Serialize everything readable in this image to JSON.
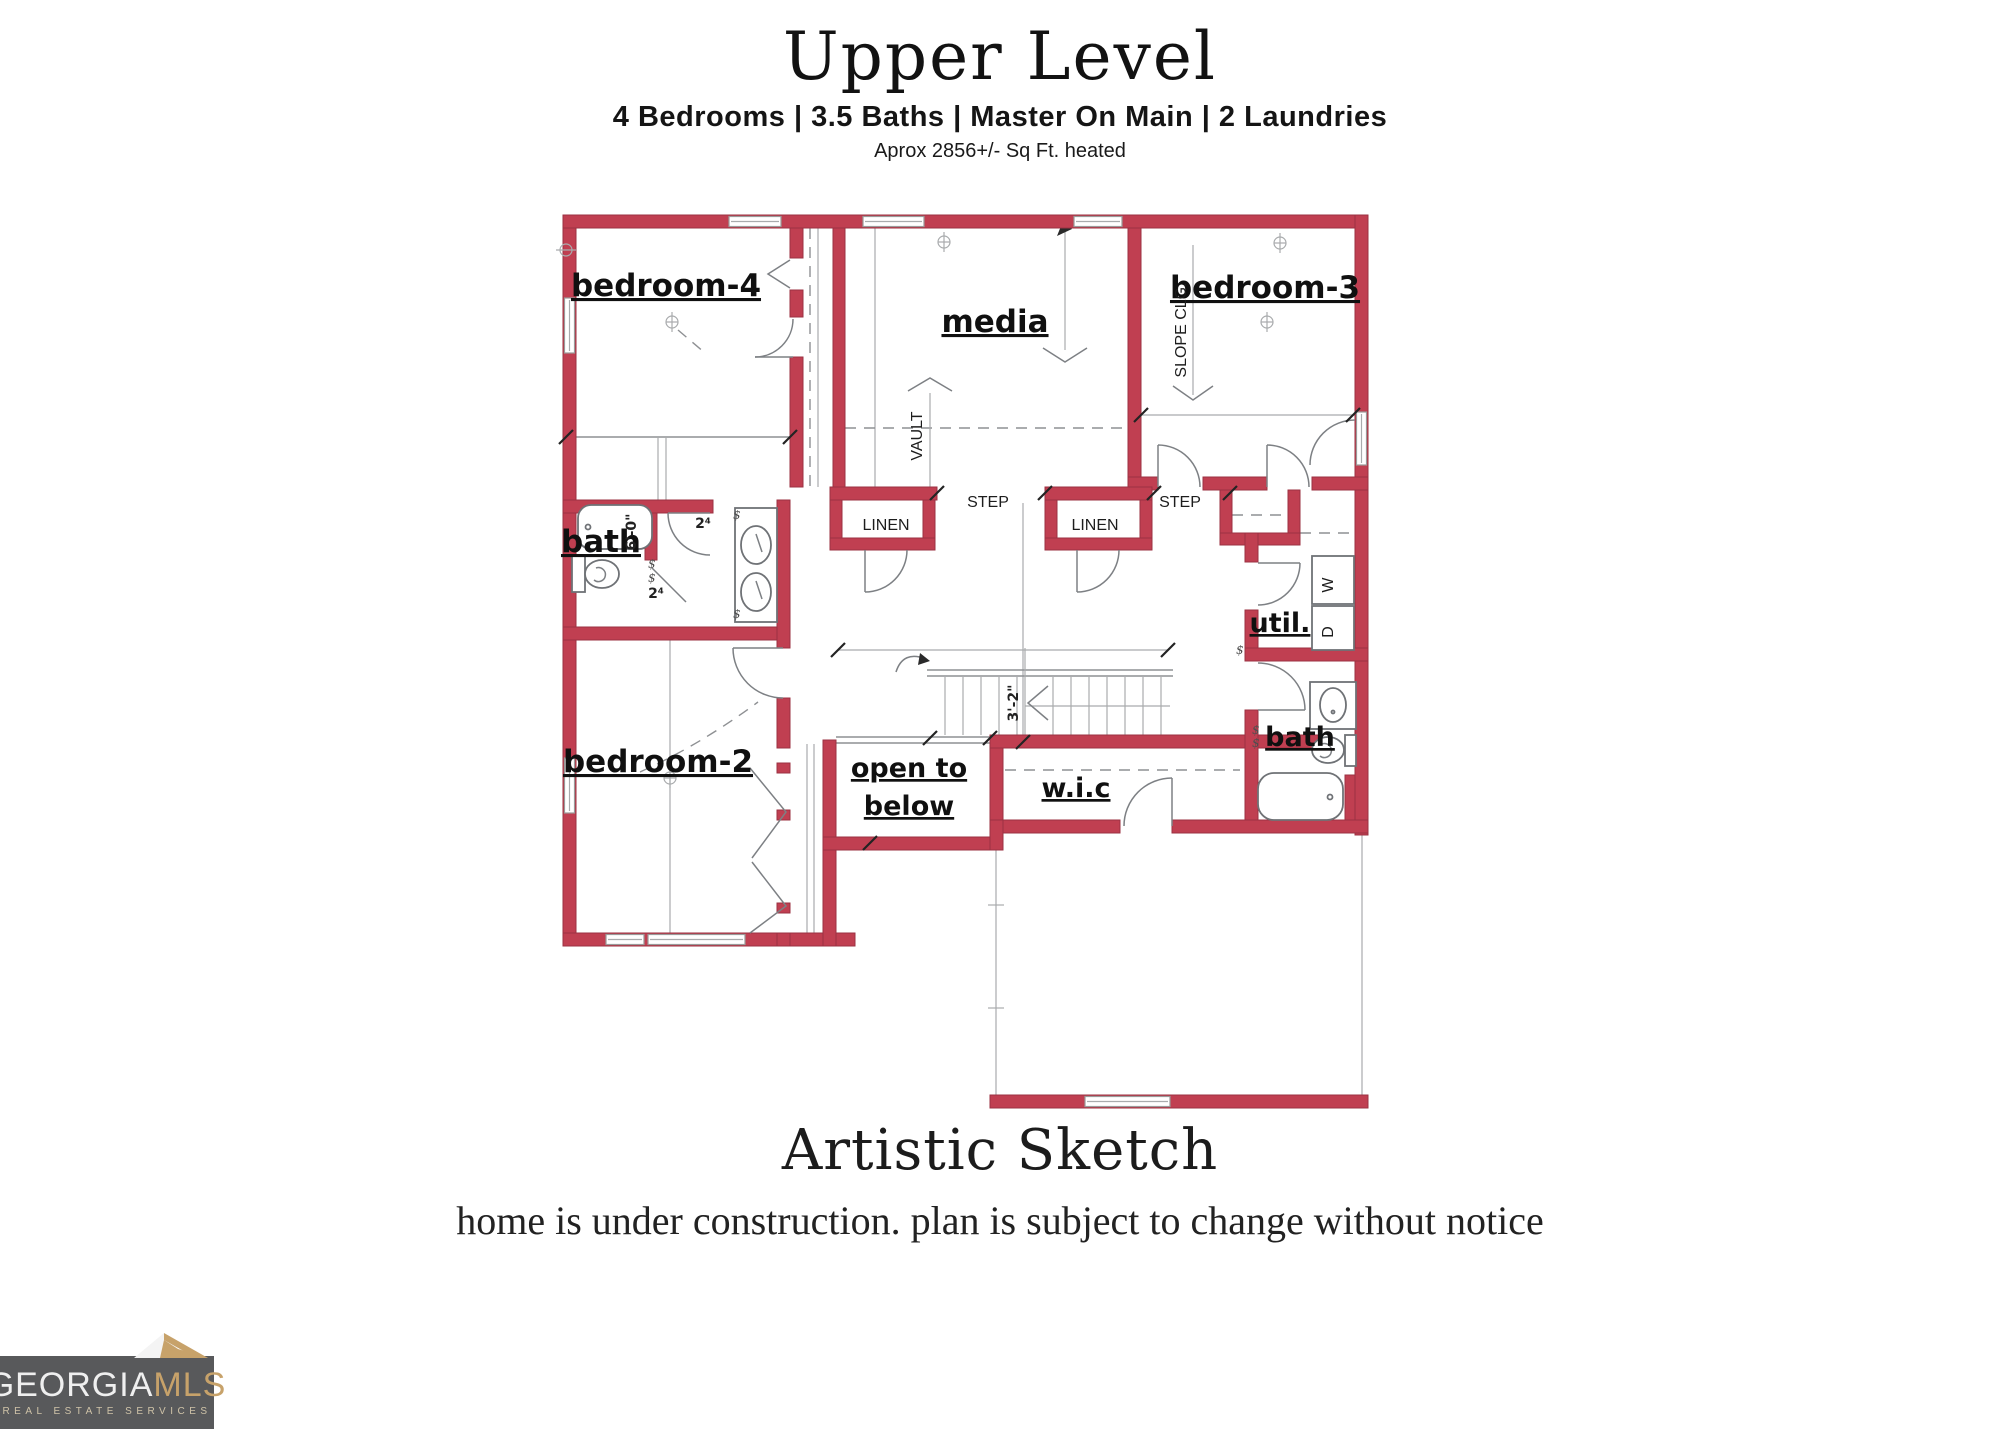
{
  "header": {
    "title": "Upper Level",
    "subtitle": "4 Bedrooms | 3.5 Baths | Master On Main | 2 Laundries",
    "area_note": "Aprox 2856+/- Sq Ft. heated"
  },
  "plan": {
    "labels": {
      "bedroom4": "bedroom-4",
      "media": "media",
      "bedroom3": "bedroom-3",
      "bath_left": "bath",
      "bedroom2": "bedroom-2",
      "util": "util.",
      "bath_right": "bath",
      "open_to_1": "open to",
      "open_to_2": "below",
      "wic": "w.i.c",
      "linen": "LINEN",
      "step": "STEP",
      "vault": "VAULT",
      "slope_clg": "SLOPE CLG.",
      "stair_width": "3'-2\"",
      "tub_dim": "6'-0\"",
      "door_size": "2⁴",
      "washer": "W",
      "dryer": "D",
      "switch": "$"
    }
  },
  "footer": {
    "title": "Artistic Sketch",
    "disclaimer": "home is under construction. plan is subject to change without notice"
  },
  "logo": {
    "name_part1": "GEORGIA",
    "name_part2": "MLS",
    "tagline": "REAL ESTATE SERVICES"
  },
  "colors": {
    "wall_red": "#c03f51",
    "line_gray": "#8e9093",
    "logo_bg": "#58595b",
    "logo_gold": "#c7a26a"
  }
}
